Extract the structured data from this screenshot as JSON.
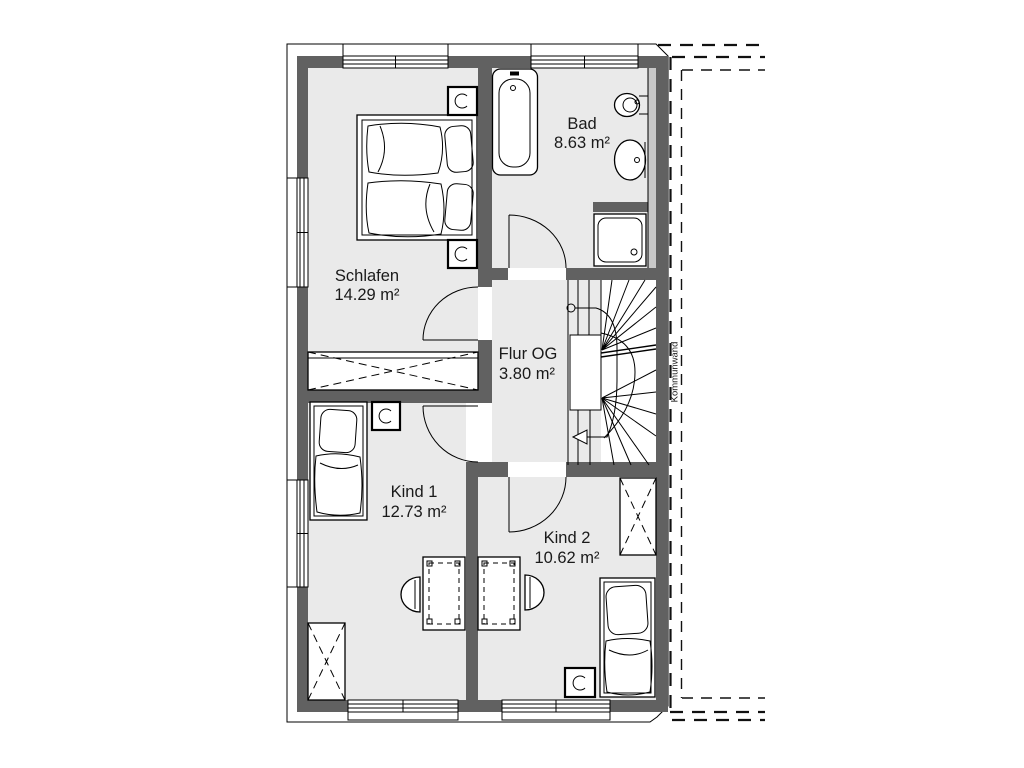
{
  "plan": {
    "rooms": [
      {
        "name": "Schlafen",
        "area": "14.29 m²"
      },
      {
        "name": "Bad",
        "area": "8.63 m²"
      },
      {
        "name": "Flur OG",
        "area": "3.80 m²"
      },
      {
        "name": "Kind 1",
        "area": "12.73 m²"
      },
      {
        "name": "Kind 2",
        "area": "10.62 m²"
      }
    ],
    "party_wall_label": "Kommunwand",
    "furniture": [
      "double-bed",
      "nightstand",
      "table-lamp",
      "wardrobe",
      "bathtub",
      "toilet",
      "washbasin",
      "shower",
      "staircase",
      "single-bed",
      "desk",
      "chair"
    ],
    "colors": {
      "wall": "#616161",
      "floor": "#eaeaea",
      "insulation": "#c8c8c8",
      "line": "#000000",
      "text": "#1a1a1a",
      "background": "#ffffff"
    }
  }
}
